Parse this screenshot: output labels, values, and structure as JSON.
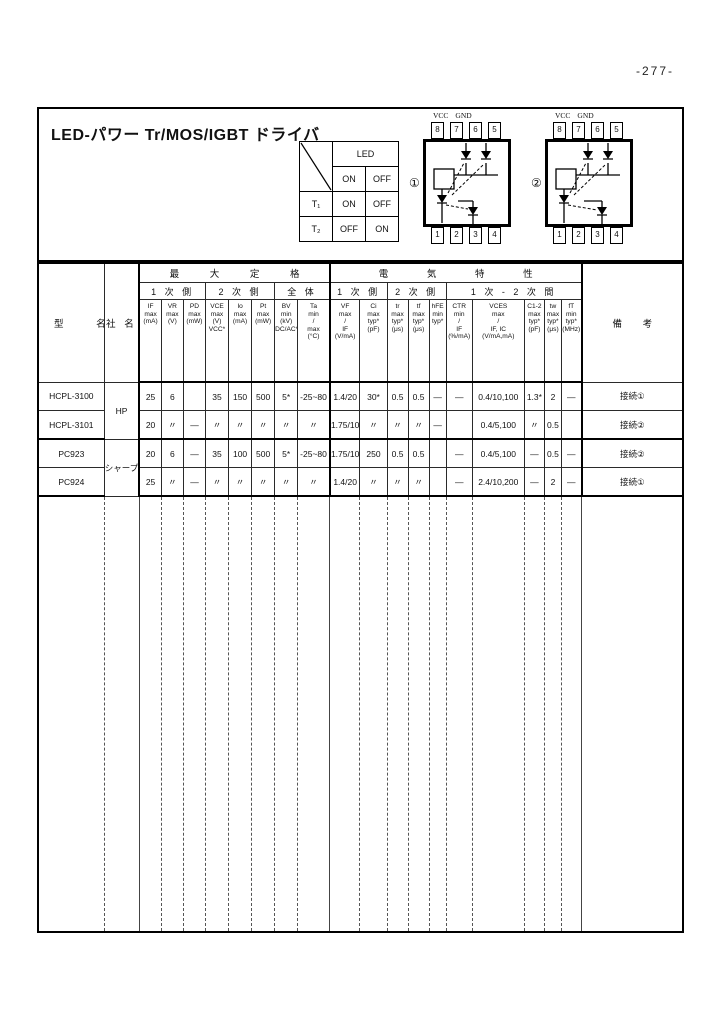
{
  "page": {
    "number": "-277-"
  },
  "panel": {
    "title": "LED-パワー Tr/MOS/IGBT ドライバ"
  },
  "logic_table": {
    "led_header": "LED",
    "state_row": [
      "ON",
      "OFF"
    ],
    "rows": [
      {
        "label": "T₁",
        "on": "ON",
        "off": "OFF"
      },
      {
        "label": "T₂",
        "on": "OFF",
        "off": "ON"
      }
    ]
  },
  "diagrams": [
    {
      "id": "①",
      "vcc": "VCC",
      "gnd": "GND",
      "top_pins": [
        "8",
        "7",
        "6",
        "5"
      ],
      "bottom_pins": [
        "1",
        "2",
        "3",
        "4"
      ]
    },
    {
      "id": "②",
      "vcc": "VCC",
      "gnd": "GND",
      "top_pins": [
        "8",
        "7",
        "6",
        "5"
      ],
      "bottom_pins": [
        "1",
        "2",
        "3",
        "4"
      ]
    }
  ],
  "table": {
    "name_header": "型 名",
    "company_header": "社 名",
    "remarks_header": "備 考",
    "group_max": "最 大 定 格",
    "group_elec": "電 気 特 性",
    "sub_headers": [
      "1 次 側",
      "2 次 側",
      "全 体",
      "1 次 側",
      "2 次 側",
      "1 次 - 2 次 間"
    ],
    "columns": [
      "IF\nmax\n(mA)",
      "VR\nmax\n(V)",
      "PD\nmax\n(mW)",
      "VCE\nmax\n(V)\nVCC*",
      "Io\nmax\n(mA)",
      "Pt\nmax\n(mW)",
      "BV\nmin\n(kV)\nDC/AC*",
      "Ta\nmin\n/\nmax\n(°C)",
      "VF\nmax\n/\nIF\n(V/mA)",
      "Ci\nmax\ntyp*\n(pF)",
      "tr\nmax\ntyp*\n(μs)",
      "tf\nmax\ntyp*\n(μs)",
      "hFE\nmin\ntyp*",
      "CTR\nmin\n/\nIF\n(%/mA)",
      "VCES\nmax\n/\nIF, IC\n(V/mA,mA)",
      "C1-2\nmax\ntyp*\n(pF)",
      "tw\nmax\ntyp*\n(μs)",
      "fT\nmin\ntyp*\n(MHz)"
    ],
    "rows": [
      {
        "name": "HCPL-3100",
        "company": "HP",
        "company_span": 2,
        "sep": false,
        "values": [
          "25",
          "6",
          "",
          "35",
          "150",
          "500",
          "5*",
          "-25~80",
          "1.4/20",
          "30*",
          "0.5",
          "0.5",
          "—",
          "—",
          "0.4/10,100",
          "1.3*",
          "2",
          "—"
        ],
        "remark": "接続①"
      },
      {
        "name": "HCPL-3101",
        "sep": true,
        "values": [
          "20",
          "〃",
          "—",
          "〃",
          "〃",
          "〃",
          "〃",
          "〃",
          "1.75/10",
          "〃",
          "〃",
          "〃",
          "—",
          "",
          "0.4/5,100",
          "〃",
          "0.5",
          ""
        ],
        "remark": "接続②"
      },
      {
        "name": "PC923",
        "company": "シャープ",
        "company_span": 2,
        "sep": false,
        "values": [
          "20",
          "6",
          "—",
          "35",
          "100",
          "500",
          "5*",
          "-25~80",
          "1.75/10",
          "250",
          "0.5",
          "0.5",
          "",
          "—",
          "0.4/5,100",
          "—",
          "0.5",
          "—"
        ],
        "remark": "接続②"
      },
      {
        "name": "PC924",
        "sep": true,
        "values": [
          "25",
          "〃",
          "—",
          "〃",
          "〃",
          "〃",
          "〃",
          "〃",
          "1.4/20",
          "〃",
          "〃",
          "〃",
          "",
          "—",
          "2.4/10,200",
          "—",
          "2",
          "—"
        ],
        "remark": "接続①"
      }
    ]
  }
}
